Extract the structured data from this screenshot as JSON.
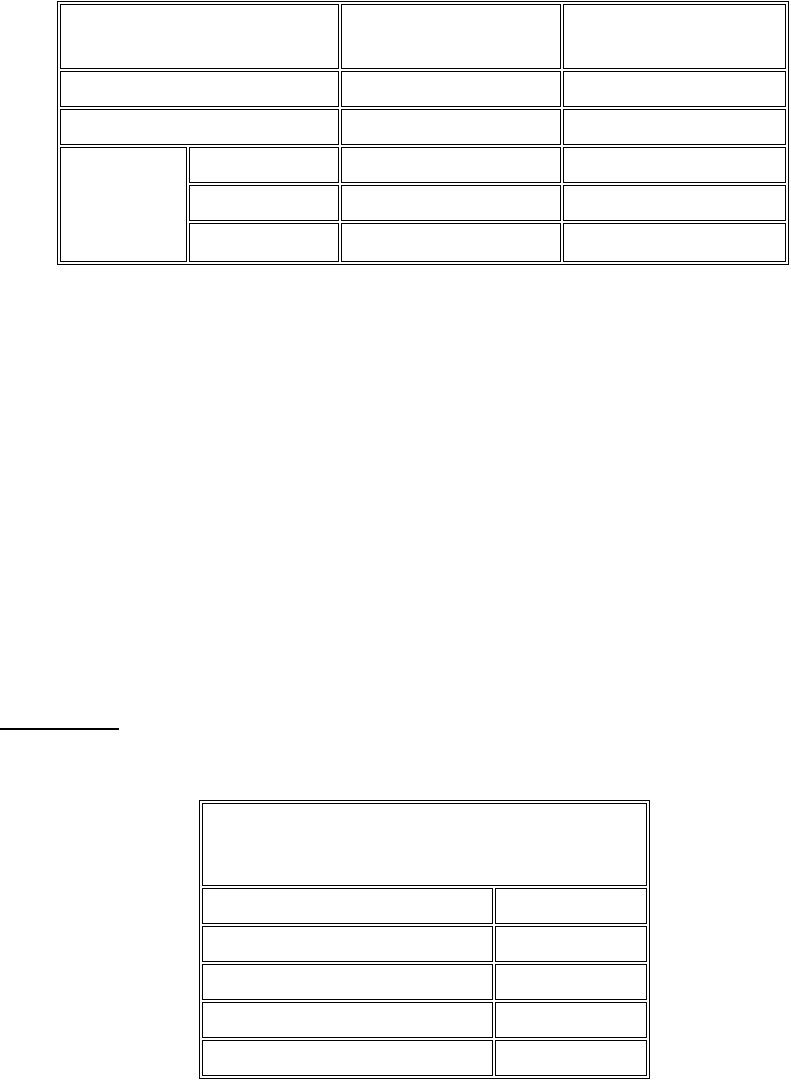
{
  "page": {
    "background_color": "#ffffff",
    "border_color": "#000000",
    "kind": "document-page-with-empty-tables"
  },
  "top_table": {
    "description": "empty 6-row table; rows 1-3 have a wide first cell (colspan 2); rows 4-6 split the first column with a cell spanning rows 4-6",
    "column_widths_px": [
      127,
      150,
      220,
      223
    ],
    "rows": [
      {
        "cells": [
          "",
          "",
          ""
        ]
      },
      {
        "cells": [
          "",
          "",
          ""
        ]
      },
      {
        "cells": [
          "",
          "",
          ""
        ]
      },
      {
        "cells": [
          "",
          "",
          "",
          ""
        ]
      },
      {
        "cells": [
          "",
          "",
          ""
        ]
      },
      {
        "cells": [
          "",
          "",
          ""
        ]
      }
    ]
  },
  "footnote_rule": {
    "present": true,
    "color": "#000000"
  },
  "bottom_table": {
    "description": "empty 6-row table; first row is a single full-width cell (colspan 2); remaining rows have a wide left column and narrow right column",
    "column_widths_px": [
      291,
      152
    ],
    "rows": [
      {
        "cells": [
          ""
        ]
      },
      {
        "cells": [
          "",
          ""
        ]
      },
      {
        "cells": [
          "",
          ""
        ]
      },
      {
        "cells": [
          "",
          ""
        ]
      },
      {
        "cells": [
          "",
          ""
        ]
      },
      {
        "cells": [
          "",
          ""
        ]
      }
    ]
  }
}
